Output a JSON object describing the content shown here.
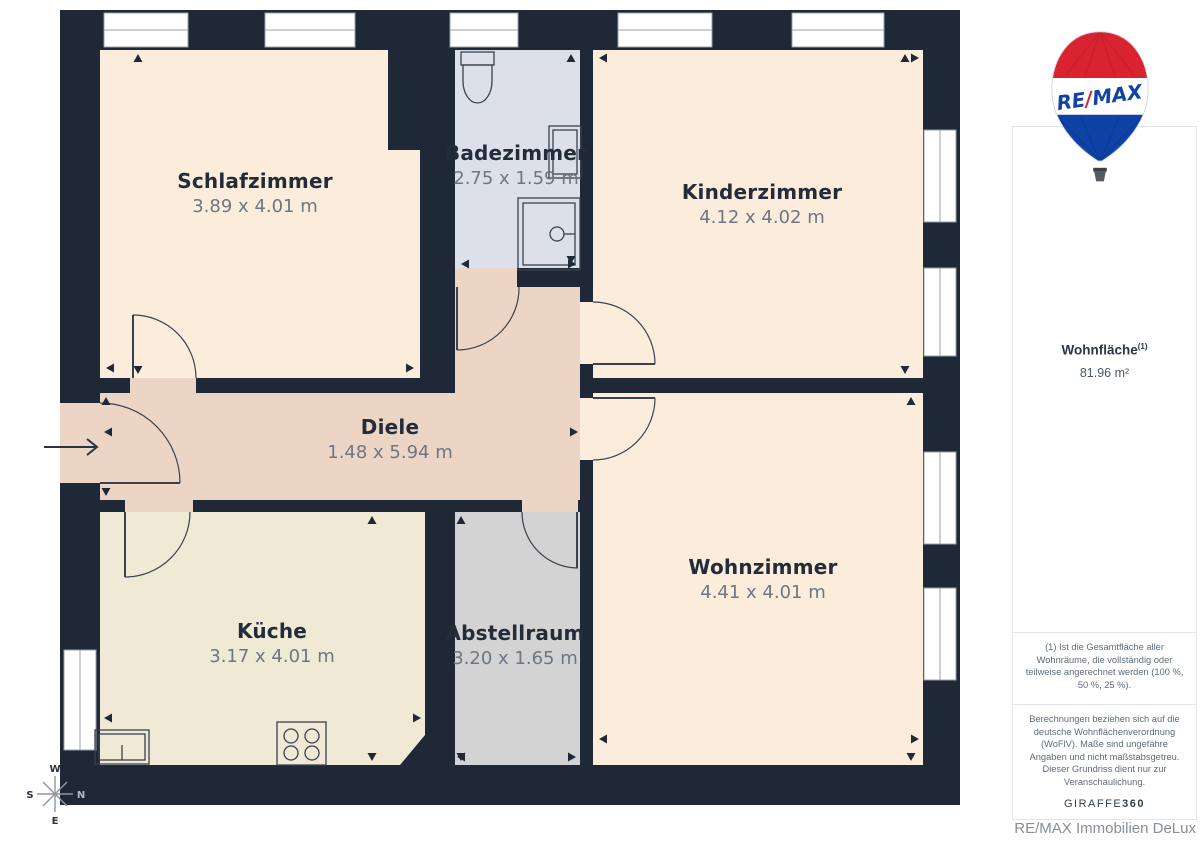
{
  "rooms": [
    {
      "name": "Schlafzimmer",
      "dims": "3.89 x 4.01 m"
    },
    {
      "name": "Badezimmer",
      "dims": "2.75 x 1.59 m"
    },
    {
      "name": "Kinderzimmer",
      "dims": "4.12 x 4.02 m"
    },
    {
      "name": "Diele",
      "dims": "1.48 x 5.94 m"
    },
    {
      "name": "Küche",
      "dims": "3.17 x 4.01 m"
    },
    {
      "name": "Abstellraum",
      "dims": "3.20 x 1.65 m"
    },
    {
      "name": "Wohnzimmer",
      "dims": "4.41 x 4.01 m"
    }
  ],
  "sidebar": {
    "area_label": "Wohnfläche",
    "area_superscript": "(1)",
    "area_value": "81.96 m²",
    "footnote1": "(1) Ist die Gesamtfläche aller Wohnräume, die vollständig oder teilweise angerechnet werden (100 %, 50 %, 25 %).",
    "footnote2": "Berechnungen beziehen sich auf die deutsche Wohnflächenverordnung (WoFlV). Maße sind ungefähre Angaben und nicht maßstabsgetreu. Dieser Grundriss dient nur zur Veranschaulichung.",
    "brand_giraffe": "GIRAFFE",
    "brand_360": "360"
  },
  "logo": {
    "re": "RE",
    "slash": "/",
    "max": "MAX"
  },
  "footer": {
    "company": "RE/MAX Immobilien DeLux"
  },
  "compass": {
    "n": "N",
    "s": "S",
    "w": "W",
    "e": "E"
  },
  "colors": {
    "wall": "#1f2836",
    "room-peach": "#fcecdc",
    "room-hall": "#edd5c6",
    "room-kitchen": "#efe9d6",
    "room-storage": "#d2d3d2",
    "room-bath": "#dbe0eb",
    "brand-red": "#d92331",
    "brand-blue": "#0f42a5",
    "label-dark": "#232c39",
    "label-gray": "#6d7683"
  }
}
